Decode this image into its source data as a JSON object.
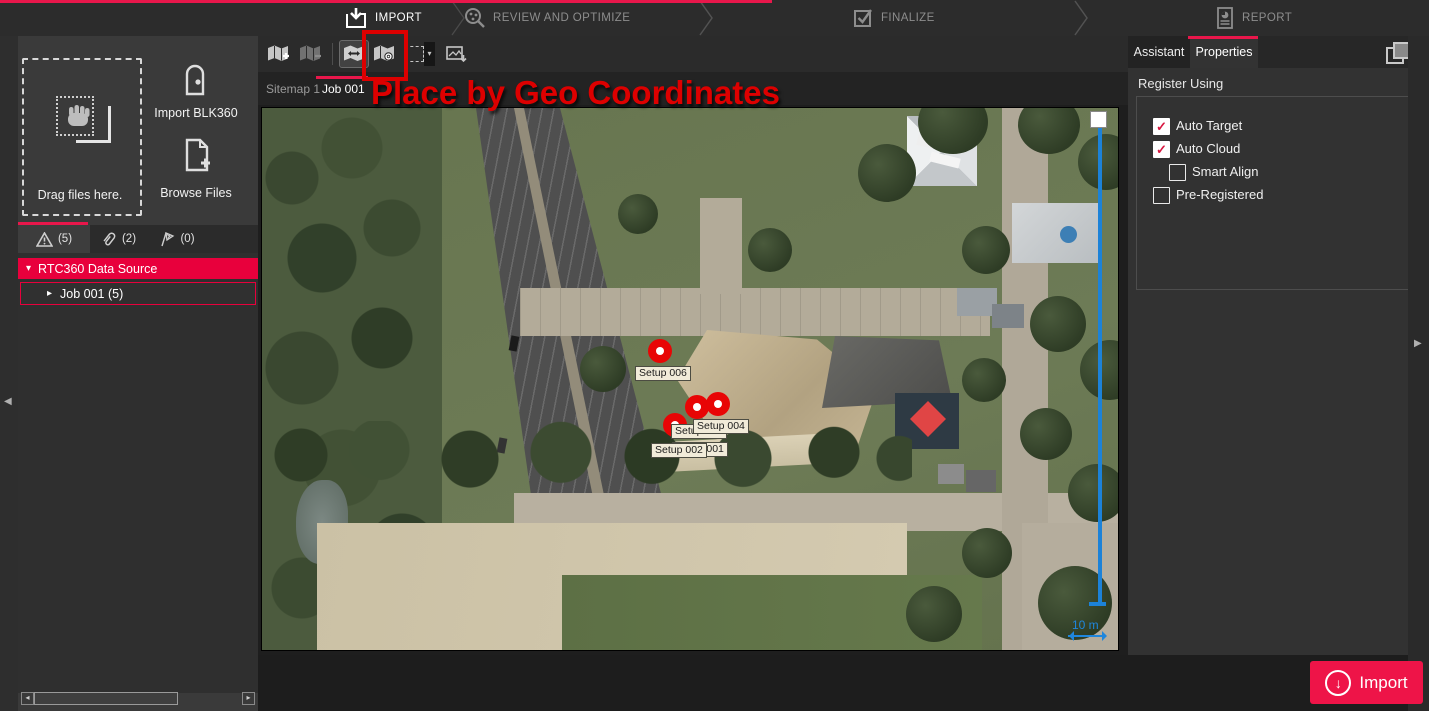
{
  "workflow": {
    "steps": [
      {
        "label": "IMPORT",
        "active": true
      },
      {
        "label": "REVIEW AND OPTIMIZE",
        "active": false
      },
      {
        "label": "FINALIZE",
        "active": false
      },
      {
        "label": "REPORT",
        "active": false
      }
    ]
  },
  "left_panel": {
    "drag_label": "Drag files here.",
    "import_blk360_label": "Import BLK360",
    "browse_files_label": "Browse Files",
    "tabs": [
      {
        "icon": "warning-icon",
        "count": "(5)"
      },
      {
        "icon": "paperclip-icon",
        "count": "(2)"
      },
      {
        "icon": "constraint-icon",
        "count": "(0)"
      }
    ],
    "tree": {
      "root": "RTC360 Data Source",
      "child": "Job 001 (5)"
    }
  },
  "center": {
    "sitemap_tabs": [
      {
        "label": "Sitemap 1",
        "active": false
      },
      {
        "label": "Job 001",
        "active": true
      }
    ],
    "annotation": {
      "text": "Place by Geo Coordinates",
      "color": "#dd0000"
    },
    "map": {
      "markers": [
        {
          "label": "Setup 006"
        },
        {
          "label": "Setup 004"
        },
        {
          "label": "Setup 003"
        },
        {
          "label": "Setup 002"
        },
        {
          "label": "Setup 001"
        }
      ],
      "scale_label": "10 m"
    }
  },
  "right_panel": {
    "tabs": [
      {
        "label": "Assistant",
        "active": false
      },
      {
        "label": "Properties",
        "active": true
      }
    ],
    "section_title": "Register Using",
    "checkboxes": [
      {
        "label": "Auto Target",
        "checked": true
      },
      {
        "label": "Auto Cloud",
        "checked": true
      },
      {
        "label": "Smart Align",
        "checked": false
      },
      {
        "label": "Pre-Registered",
        "checked": false
      }
    ]
  },
  "footer": {
    "import_button": "Import"
  },
  "icons": {
    "check": "✓",
    "expander_open": "▾",
    "expander_closed": "▸",
    "collapse_left": "◀",
    "expand_right": "▶",
    "caret_down": "▾",
    "scroll_left": "◂",
    "scroll_right": "▸",
    "down_arrow": "↓",
    "swap": "⇄"
  },
  "colors": {
    "accent": "#e8174b",
    "selection": "#e8003c",
    "annotation": "#dd0000",
    "measure_line": "#1c82d8"
  }
}
